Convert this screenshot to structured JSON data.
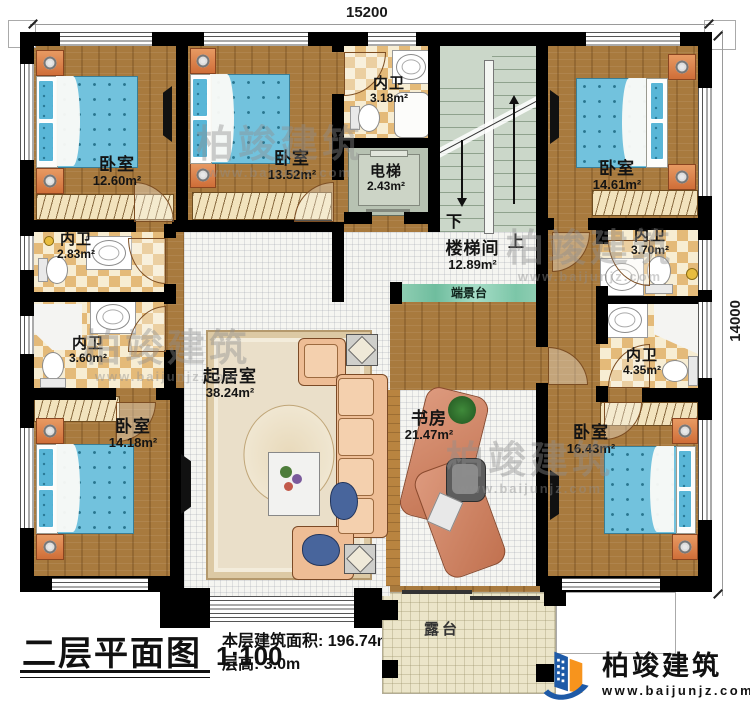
{
  "title_block": {
    "title": "二层平面图",
    "scale": "1:100",
    "area_line": "本层建筑面积: 196.74m²",
    "height_line": "层高: 3.0m"
  },
  "dims": {
    "width": "15200",
    "depth": "14000"
  },
  "rooms": {
    "bedroom_tl": {
      "name": "卧室",
      "area": "12.60m²"
    },
    "bedroom_tm": {
      "name": "卧室",
      "area": "13.52m²"
    },
    "bedroom_tr": {
      "name": "卧室",
      "area": "14.61m²"
    },
    "bedroom_bl": {
      "name": "卧室",
      "area": "14.18m²"
    },
    "bedroom_br": {
      "name": "卧室",
      "area": "16.43m²"
    },
    "bath_top": {
      "name": "内卫",
      "area": "3.18m²"
    },
    "bath_l1": {
      "name": "内卫",
      "area": "2.83m²"
    },
    "bath_l2": {
      "name": "内卫",
      "area": "3.60m²"
    },
    "bath_r1": {
      "name": "内卫",
      "area": "3.70m²"
    },
    "bath_r2": {
      "name": "内卫",
      "area": "4.35m²"
    },
    "elevator": {
      "name": "电梯",
      "area": "2.43m²"
    },
    "stairwell": {
      "name": "楼梯间",
      "area": "12.89m²"
    },
    "living": {
      "name": "起居室",
      "area": "38.24m²"
    },
    "study": {
      "name": "书房",
      "area": "21.47m²"
    },
    "terrace": {
      "name": "露台"
    },
    "platform": {
      "name": "端景台"
    }
  },
  "stairs": {
    "down": "下",
    "up": "上"
  },
  "brand": {
    "name": "柏竣建筑",
    "url": "www.baijunjz.com"
  },
  "watermark": {
    "name": "柏竣建筑",
    "url": "www.baijunjz.com"
  },
  "colors": {
    "wall": "#000000",
    "wood": "#a87a3e",
    "tile": "#e4ba79",
    "stair": "#cbd7c9",
    "platform_teal": "#7cc6a8",
    "terrace": "#ebe5c9",
    "bed_blue": "#72c2dd",
    "sofa_peach": "#eebd95",
    "brand_blue": "#1e5aa7",
    "brand_orange": "#f7941d"
  }
}
